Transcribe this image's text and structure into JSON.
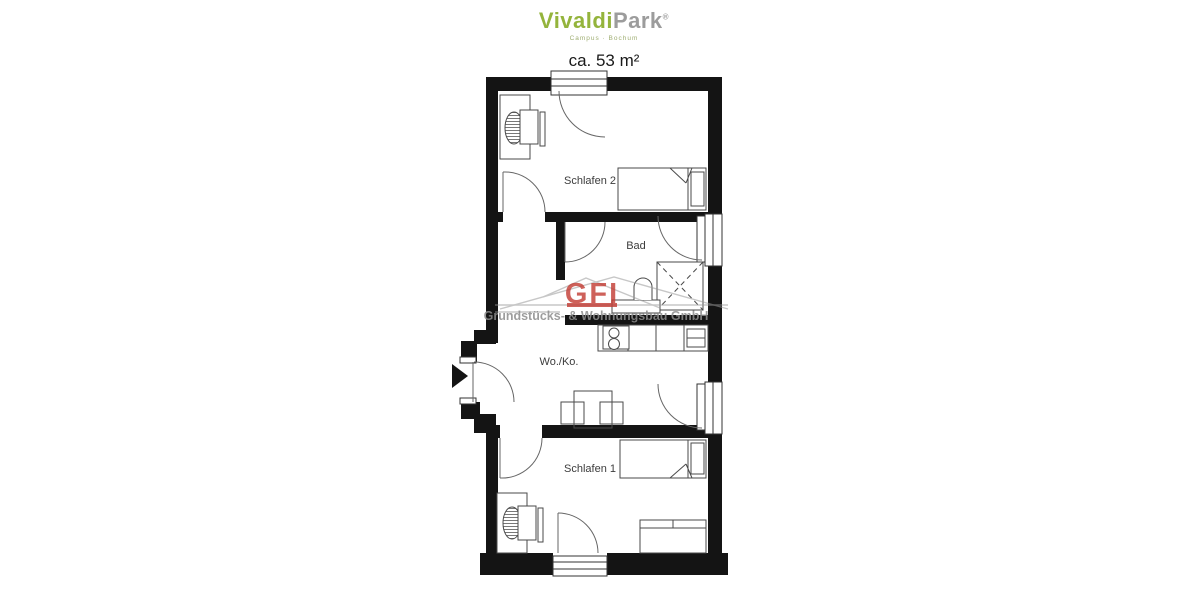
{
  "header": {
    "brand": {
      "primary": "Vivaldi",
      "secondary": "Park",
      "mark": "®",
      "tagline": "Campus · Bochum",
      "primary_color": "#94b43c",
      "secondary_color": "#9c9c9c"
    },
    "area_label": "ca. 53 m²"
  },
  "floor_plan": {
    "rooms": [
      {
        "name": "Schlafen 2"
      },
      {
        "name": "Bad"
      },
      {
        "name": "Wo./Ko."
      },
      {
        "name": "Schlafen 1"
      }
    ],
    "wall_color": "#141414"
  },
  "watermark": {
    "abbrev": "GFI",
    "company": "Grundstücks- & Wohnungsbau GmbH",
    "abbrev_color": "#c23a32",
    "text_color": "#8d8d8d"
  }
}
